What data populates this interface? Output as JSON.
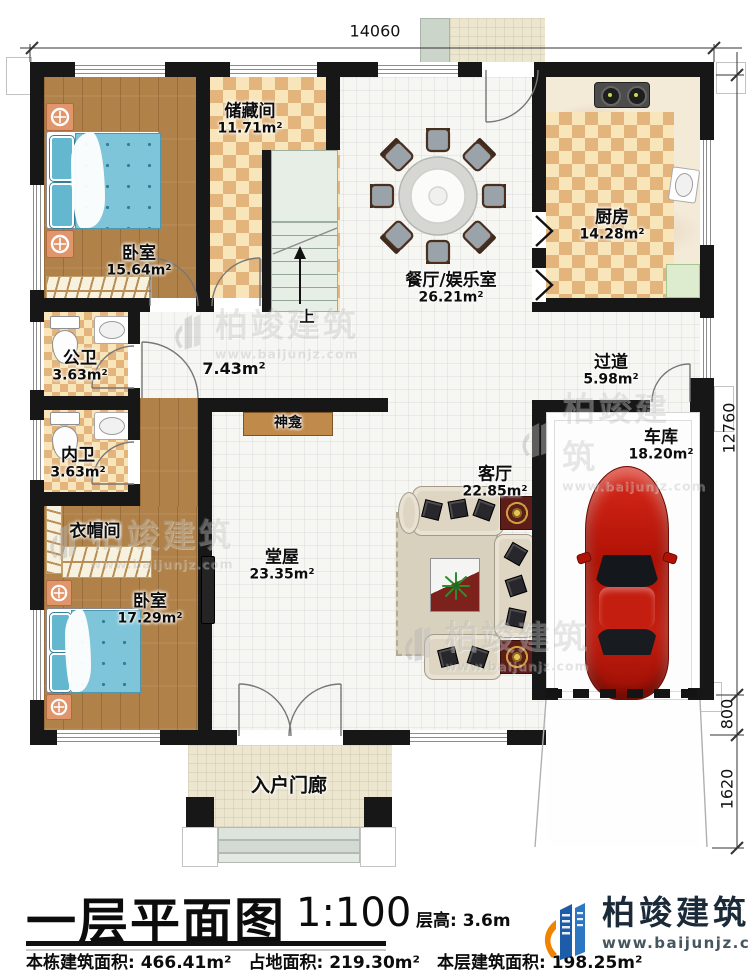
{
  "plan": {
    "dim_top": "14060",
    "dim_right": "12760",
    "dim_800": "800",
    "dim_1620": "1620",
    "stairs_up": "上"
  },
  "rooms": {
    "bedroom1": {
      "name": "卧室",
      "area": "15.64m²"
    },
    "storage": {
      "name": "储藏间",
      "area": "11.71m²"
    },
    "dining": {
      "name": "餐厅/娱乐室",
      "area": "26.21m²"
    },
    "kitchen": {
      "name": "厨房",
      "area": "14.28m²"
    },
    "public_wc": {
      "name": "公卫",
      "area": "3.63m²"
    },
    "inner_wc": {
      "name": "内卫",
      "area": "3.63m²"
    },
    "cloakroom": {
      "name": "衣帽间"
    },
    "corridor": {
      "area": "7.43m²"
    },
    "passage": {
      "name": "过道",
      "area": "5.98m²"
    },
    "hall": {
      "name": "堂屋",
      "area": "23.35m²"
    },
    "living": {
      "name": "客厅",
      "area": "22.85m²"
    },
    "bedroom2": {
      "name": "卧室",
      "area": "17.29m²"
    },
    "garage": {
      "name": "车库",
      "area": "18.20m²"
    },
    "shrine": {
      "name": "神龛"
    },
    "porch": {
      "name": "入户门廊"
    }
  },
  "titleblock": {
    "title": "一层平面图",
    "scale": "1:100",
    "floor_height": "层高: 3.6m",
    "building_area": "本栋建筑面积: 466.41m²",
    "land_area": "占地面积: 219.30m²",
    "floor_area": "本层建筑面积: 198.25m²"
  },
  "brand": {
    "company": "柏竣建筑",
    "website": "www.baijunjz.com"
  },
  "colors": {
    "wall": "#171717",
    "wood": "#b08249",
    "checker_dark": "#e3b47c",
    "checker_light": "#f8e6ba",
    "brand_blue": "#1d5ca8",
    "brand_orange": "#f08300",
    "car_red": "#c41e10"
  }
}
